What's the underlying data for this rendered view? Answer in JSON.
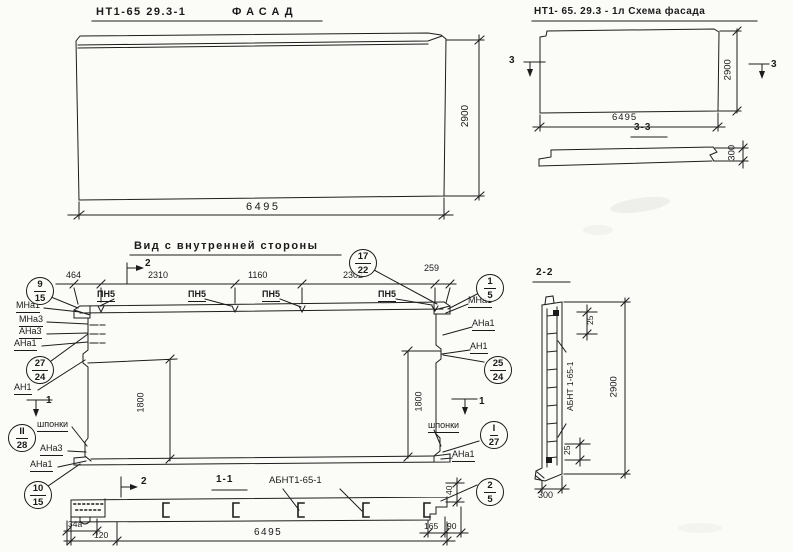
{
  "facade": {
    "code": "НТ1-65 29.3-1",
    "name": "ФАСАД",
    "dim_width": "6495",
    "dim_height": "2900"
  },
  "scheme": {
    "title": "НТ1- 65. 29.3 - 1л Схема фасада",
    "dim_width": "6495",
    "dim_height": "2900",
    "dim_strip": "300",
    "section_label": "3-3",
    "mark": "3"
  },
  "inner": {
    "title": "Вид с внутренней стороны",
    "dims_top": [
      "464",
      "2310",
      "1160",
      "2302",
      "259"
    ],
    "dim_left": "1800",
    "dim_right": "1800",
    "plates": [
      "ПН5",
      "ПН5",
      "ПН5",
      "ПН5"
    ],
    "mark_section_2": "2",
    "mark_section_1": "1",
    "left_labels": [
      "МНа1",
      "МНа3",
      "АНа3",
      "АНа1",
      "АН1",
      "шпонки",
      "АНа3",
      "АНа1"
    ],
    "right_labels": [
      "МНа1",
      "АНа1",
      "АН1",
      "шпонки",
      "АНа1"
    ],
    "c17_22": {
      "top": "17",
      "bot": "22"
    },
    "c9_15": {
      "top": "9",
      "bot": "15"
    },
    "c27_24": {
      "top": "27",
      "bot": "24"
    },
    "c2_28": {
      "top": "II",
      "bot": "28"
    },
    "c10_15": {
      "top": "10",
      "bot": "15"
    },
    "c1_5": {
      "top": "1",
      "bot": "5"
    },
    "c25_24": {
      "top": "25",
      "bot": "24"
    },
    "c1_27": {
      "top": "I",
      "bot": "27"
    },
    "c2_5": {
      "top": "2",
      "bot": "5"
    }
  },
  "section_1_1": {
    "label": "1-1",
    "mark": "2",
    "anchor_ref": "АБНТ1-65-1",
    "dim_34a": "34а",
    "dim_120": "120",
    "dim_6495": "6495",
    "dim_165": "165",
    "dim_90": "90",
    "dim_40": "40"
  },
  "section_2_2": {
    "label": "2-2",
    "anchor_ref": "АБНТ 1-65-1",
    "dim_25_top": "25",
    "dim_25_bottom": "25",
    "dim_2900": "2900",
    "dim_300": "300"
  }
}
